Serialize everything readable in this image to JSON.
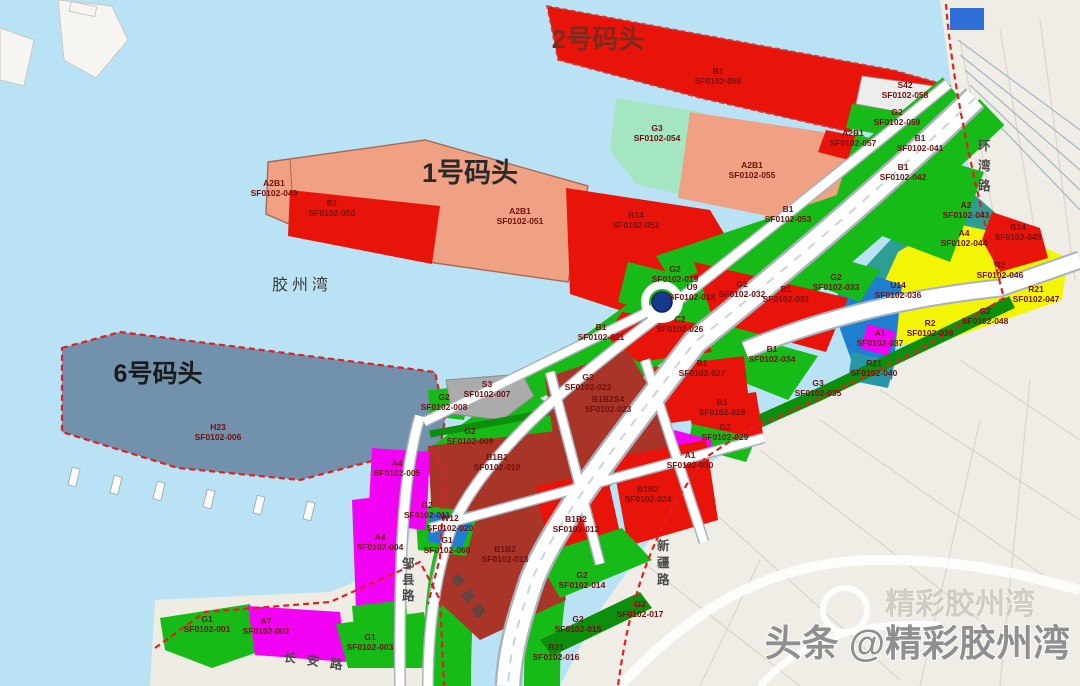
{
  "map": {
    "titles": {
      "pier2": "2号码头",
      "pier1": "1号码头",
      "pier6": "6号码头",
      "bay": "胶州湾"
    },
    "watermark": {
      "text": "头条 @精彩胶州湾",
      "ghost": "精彩胶州湾"
    },
    "roads": [
      {
        "name": "环湾路",
        "x": 978,
        "y": 150,
        "mode": "v",
        "step": 20
      },
      {
        "name": "新疆路",
        "x": 657,
        "y": 550,
        "mode": "v",
        "step": 17
      },
      {
        "name": "邹县路",
        "x": 402,
        "y": 568,
        "mode": "v",
        "step": 16
      },
      {
        "name": "莘县路",
        "x": 450,
        "y": 578,
        "mode": "r",
        "deg": 55,
        "spacing": 6
      },
      {
        "name": "长安路",
        "x": 283,
        "y": 661,
        "mode": "r",
        "deg": 8,
        "spacing": 11
      }
    ],
    "parcels": [
      {
        "type": "B1",
        "code": "SF0102-056",
        "x": 718,
        "y": 74
      },
      {
        "type": "S42",
        "code": "SF0102-058",
        "x": 905,
        "y": 88
      },
      {
        "type": "G2",
        "code": "SF0102-059",
        "x": 897,
        "y": 115
      },
      {
        "type": "A2B1",
        "code": "SF0102-057",
        "x": 853,
        "y": 136
      },
      {
        "type": "G3",
        "code": "SF0102-054",
        "x": 657,
        "y": 131
      },
      {
        "type": "A2B1",
        "code": "SF0102-055",
        "x": 752,
        "y": 168
      },
      {
        "type": "B1",
        "code": "SF0102-041",
        "x": 920,
        "y": 141
      },
      {
        "type": "B1",
        "code": "SF0102-042",
        "x": 903,
        "y": 170
      },
      {
        "type": "A2B1",
        "code": "SF0102-049",
        "x": 274,
        "y": 186
      },
      {
        "type": "B1",
        "code": "SF0102-050",
        "x": 332,
        "y": 206
      },
      {
        "type": "A2B1",
        "code": "SF0102-051",
        "x": 520,
        "y": 214
      },
      {
        "type": "B14",
        "code": "SF0102-052",
        "x": 636,
        "y": 218
      },
      {
        "type": "B1",
        "code": "SF0102-053",
        "x": 788,
        "y": 212
      },
      {
        "type": "H23",
        "code": "SF0102-006",
        "x": 218,
        "y": 430
      },
      {
        "type": "A2",
        "code": "SF0102-043",
        "x": 966,
        "y": 208
      },
      {
        "type": "A4",
        "code": "SF0102-044",
        "x": 964,
        "y": 236
      },
      {
        "type": "B14",
        "code": "SF0102-045",
        "x": 1018,
        "y": 230
      },
      {
        "type": "R2",
        "code": "SF0102-046",
        "x": 1000,
        "y": 268
      },
      {
        "type": "U14",
        "code": "SF0102-036",
        "x": 898,
        "y": 288
      },
      {
        "type": "R21",
        "code": "SF0102-047",
        "x": 1036,
        "y": 292
      },
      {
        "type": "G2",
        "code": "SF0102-048",
        "x": 985,
        "y": 314
      },
      {
        "type": "R2",
        "code": "SF0102-039",
        "x": 930,
        "y": 326
      },
      {
        "type": "A1",
        "code": "SF0102-037",
        "x": 880,
        "y": 336
      },
      {
        "type": "R21",
        "code": "SF0102-040",
        "x": 874,
        "y": 366
      },
      {
        "type": "G3",
        "code": "SF0102-035",
        "x": 818,
        "y": 386
      },
      {
        "type": "G2",
        "code": "SF0102-033",
        "x": 836,
        "y": 280
      },
      {
        "type": "B1",
        "code": "SF0102-031",
        "x": 786,
        "y": 292
      },
      {
        "type": "B1",
        "code": "SF0102-034",
        "x": 772,
        "y": 352
      },
      {
        "type": "G2",
        "code": "SF0102-032",
        "x": 742,
        "y": 287
      },
      {
        "type": "U9",
        "code": "SF0102-018",
        "x": 692,
        "y": 290
      },
      {
        "type": "G2",
        "code": "SF0102-019",
        "x": 675,
        "y": 272
      },
      {
        "type": "B1",
        "code": "SF0102-021",
        "x": 601,
        "y": 330
      },
      {
        "type": "C2",
        "code": "SF0102-026",
        "x": 680,
        "y": 322
      },
      {
        "type": "B1",
        "code": "SF0102-027",
        "x": 702,
        "y": 366
      },
      {
        "type": "B1",
        "code": "SF0102-028",
        "x": 722,
        "y": 405
      },
      {
        "type": "G2",
        "code": "SF0102-029",
        "x": 725,
        "y": 430
      },
      {
        "type": "A1",
        "code": "SF0102-030",
        "x": 690,
        "y": 458
      },
      {
        "type": "G2",
        "code": "SF0102-022",
        "x": 588,
        "y": 380
      },
      {
        "type": "S3",
        "code": "SF0102-007",
        "x": 487,
        "y": 387
      },
      {
        "type": "G2",
        "code": "SF0102-008",
        "x": 444,
        "y": 400
      },
      {
        "type": "G2",
        "code": "SF0102-009",
        "x": 470,
        "y": 434
      },
      {
        "type": "B1B2",
        "code": "SF0102-010",
        "x": 497,
        "y": 460
      },
      {
        "type": "B1B2S4",
        "code": "SF0102-023",
        "x": 608,
        "y": 402
      },
      {
        "type": "B1B2",
        "code": "SF0102-024",
        "x": 648,
        "y": 492
      },
      {
        "type": "B1B2",
        "code": "SF0102-012",
        "x": 576,
        "y": 522
      },
      {
        "type": "B1B2",
        "code": "SF0102-013",
        "x": 505,
        "y": 552
      },
      {
        "type": "G2",
        "code": "SF0102-014",
        "x": 582,
        "y": 578
      },
      {
        "type": "G2",
        "code": "SF0102-011",
        "x": 427,
        "y": 508
      },
      {
        "type": "W12",
        "code": "SF0102-020",
        "x": 450,
        "y": 521
      },
      {
        "type": "G1",
        "code": "SF0102-060",
        "x": 447,
        "y": 543
      },
      {
        "type": "A4",
        "code": "SF0102-005",
        "x": 397,
        "y": 466
      },
      {
        "type": "A4",
        "code": "SF0102-004",
        "x": 380,
        "y": 540
      },
      {
        "type": "G1",
        "code": "SF0102-001",
        "x": 207,
        "y": 622
      },
      {
        "type": "A7",
        "code": "SF0102-002",
        "x": 266,
        "y": 624
      },
      {
        "type": "G1",
        "code": "SF0102-003",
        "x": 370,
        "y": 640
      },
      {
        "type": "G2",
        "code": "SF0102-015",
        "x": 578,
        "y": 622
      },
      {
        "type": "B21",
        "code": "SF0102-016",
        "x": 556,
        "y": 650
      },
      {
        "type": "G2",
        "code": "SF0102-017",
        "x": 640,
        "y": 607
      }
    ],
    "colors": {
      "water": "#b9e3f4",
      "land": "#f0ede6",
      "red": "#e91409",
      "dark_red": "#a93528",
      "salmon": "#f0a183",
      "mint": "#a5e6c2",
      "green": "#17bb17",
      "dark_green": "#0c8f0c",
      "teal": "#2d9f92",
      "yellow": "#f4f407",
      "blue": "#1e7fd0",
      "slate": "#7291ac",
      "magenta": "#f303f3",
      "gray": "#ababab",
      "white_parcel": "#ededed",
      "boundary": "#e02020",
      "label_text": "#70100e"
    }
  }
}
